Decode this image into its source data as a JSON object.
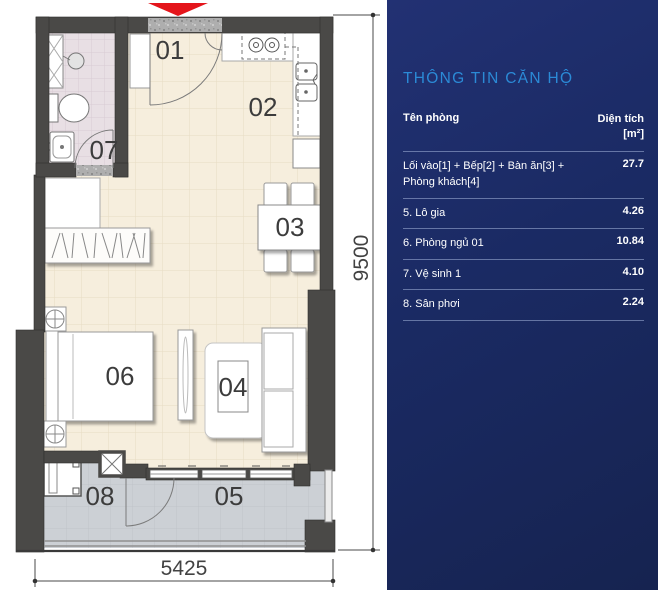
{
  "plan": {
    "room_labels": [
      "01",
      "02",
      "03",
      "04",
      "05",
      "06",
      "07",
      "08"
    ],
    "dim_height": "9500",
    "dim_width": "5425"
  },
  "panel": {
    "title": "THÔNG TIN CĂN HỘ",
    "columns": {
      "room": "Tên phòng",
      "area": "Diện tích",
      "area_unit": "[m²]"
    },
    "rows": [
      {
        "name": "Lối vào[1] + Bếp[2] + Bàn ăn[3] + Phòng khách[4]",
        "area": "27.7"
      },
      {
        "name": "5. Lô gia",
        "area": "4.26"
      },
      {
        "name": "6. Phòng ngủ 01",
        "area": "10.84"
      },
      {
        "name": "7. Vệ sinh 1",
        "area": "4.10"
      },
      {
        "name": "8. Sân phơi",
        "area": "2.24"
      }
    ]
  },
  "colors": {
    "panel_navy": "#1a2a63",
    "title_blue": "#2b8ad6",
    "entrance_arrow_red": "#e4151b",
    "wall_dark": "#4a4947",
    "floor_beige": "#f6eedd",
    "floor_bath": "#e8dfe4",
    "floor_loggia": "#ccd0d5"
  }
}
